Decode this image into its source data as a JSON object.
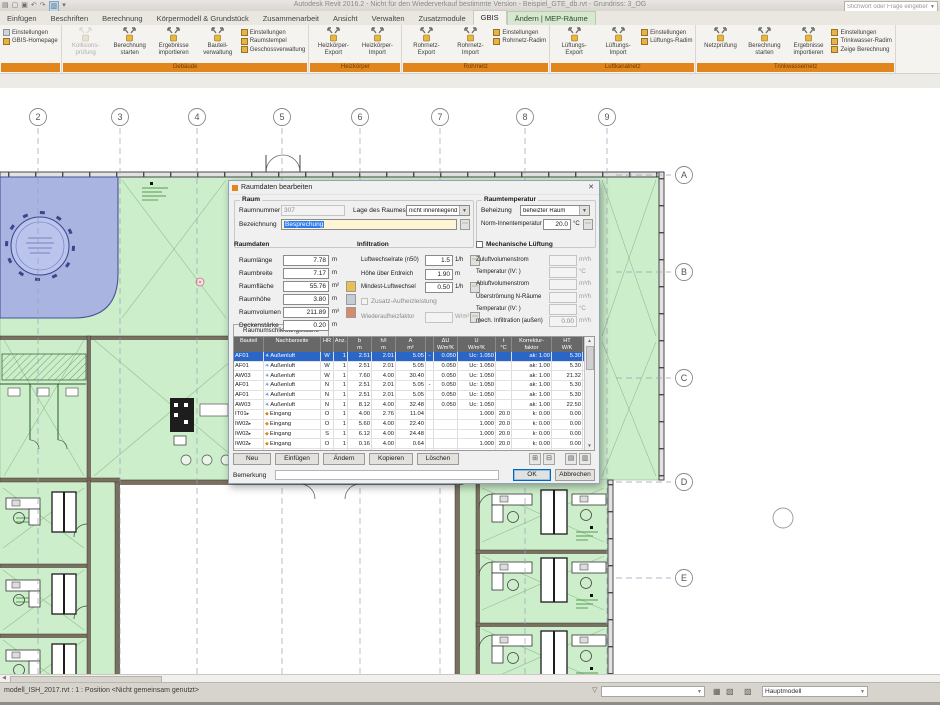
{
  "colors": {
    "ribbon_group_orange": "#e1861c",
    "room_green": "#cdeecb",
    "room_blue": "#a9b4e0",
    "selection_blue": "#2a65c8",
    "contextual_tab_green": "#d8e8d0"
  },
  "titlebar": {
    "title": "Autodesk Revit 2016.2 - Nicht für den Wiederverkauf bestimmte Version - Beispiel_GTE_db.rvt - Grundriss: 3_OG",
    "search_placeholder": "Stichwort oder Frage eingeben",
    "qat_icons": [
      "menu-icon",
      "open-icon",
      "save-icon",
      "undo-icon",
      "redo-icon",
      "print-icon",
      "highlight-icon"
    ]
  },
  "tabs": [
    {
      "label": "Einfügen",
      "active": false,
      "contextual": false
    },
    {
      "label": "Beschriften",
      "active": false,
      "contextual": false
    },
    {
      "label": "Berechnung",
      "active": false,
      "contextual": false
    },
    {
      "label": "Körpermodell & Grundstück",
      "active": false,
      "contextual": false
    },
    {
      "label": "Zusammenarbeit",
      "active": false,
      "contextual": false
    },
    {
      "label": "Ansicht",
      "active": false,
      "contextual": false
    },
    {
      "label": "Verwalten",
      "active": false,
      "contextual": false
    },
    {
      "label": "Zusatzmodule",
      "active": false,
      "contextual": false
    },
    {
      "label": "GBIS",
      "active": true,
      "contextual": false
    },
    {
      "label": "Ändern | MEP-Räume",
      "active": false,
      "contextual": true
    }
  ],
  "ribbon": {
    "partial_group": [
      {
        "label": "Einstellungen"
      },
      {
        "label": "GBIS-Homepage"
      }
    ],
    "groups": [
      {
        "label": "Gebäude",
        "big": [
          {
            "l1": "Kollisions-",
            "l2": "prüfung",
            "disabled": true
          },
          {
            "l1": "Berechnung",
            "l2": "starten",
            "disabled": false
          },
          {
            "l1": "Ergebnisse",
            "l2": "importieren",
            "disabled": false
          },
          {
            "l1": "Bauteil-",
            "l2": "verwaltung",
            "disabled": false
          }
        ],
        "stack": [
          "Einstellungen",
          "Raumstempel",
          "Geschossverwaltung"
        ]
      },
      {
        "label": "Heizkörper",
        "big": [
          {
            "l1": "Heizkörper-",
            "l2": "Export",
            "disabled": false
          },
          {
            "l1": "Heizkörper-",
            "l2": "Import",
            "disabled": false
          }
        ],
        "stack": []
      },
      {
        "label": "Rohrnetz",
        "big": [
          {
            "l1": "Rohrnetz-",
            "l2": "Export",
            "disabled": false
          },
          {
            "l1": "Rohrnetz-",
            "l2": "Import",
            "disabled": false
          }
        ],
        "stack": [
          "Einstellungen",
          "Rohrnetz-Radim"
        ]
      },
      {
        "label": "Luftkanalnetz",
        "big": [
          {
            "l1": "Lüftungs-",
            "l2": "Export",
            "disabled": false
          },
          {
            "l1": "Lüftungs-",
            "l2": "Import",
            "disabled": false
          }
        ],
        "stack": [
          "Einstellungen",
          "Lüftungs-Radim"
        ]
      },
      {
        "label": "Trinkwassernetz",
        "big": [
          {
            "l1": "Netzprüfung",
            "l2": "",
            "disabled": false
          },
          {
            "l1": "Berechnung",
            "l2": "starten",
            "disabled": false
          },
          {
            "l1": "Ergebnisse",
            "l2": "importieren",
            "disabled": false
          }
        ],
        "stack": [
          "Einstellungen",
          "Trinkwasser-Radim",
          "Zeige Berechnung"
        ]
      }
    ]
  },
  "plan": {
    "grid_numbers": [
      "2",
      "3",
      "4",
      "5",
      "6",
      "7",
      "8",
      "9"
    ],
    "grid_letters": [
      "A",
      "B",
      "C",
      "D",
      "E"
    ]
  },
  "dialog": {
    "title": "Raumdaten bearbeiten",
    "raum": {
      "label": "Raum",
      "raumnummer_label": "Raumnummer",
      "raumnummer_value": "307",
      "lage_label": "Lage des Raumes",
      "lage_value": "nicht innenliegend",
      "bezeichnung_label": "Bezeichnung",
      "bezeichnung_value": "Besprechung"
    },
    "raumtemperatur": {
      "label": "Raumtemperatur",
      "beheizung_label": "Beheizung",
      "beheizung_value": "beheizter Raum",
      "norm_label": "Norm-Innentemperatur",
      "norm_value": "20.0",
      "norm_unit": "°C"
    },
    "raumdaten": {
      "label": "Raumdaten",
      "rows": [
        {
          "label": "Raumlänge",
          "value": "7.78",
          "unit": "m",
          "icon": ""
        },
        {
          "label": "Raumbreite",
          "value": "7.17",
          "unit": "m",
          "icon": ""
        },
        {
          "label": "Raumfläche",
          "value": "55.76",
          "unit": "m²",
          "icon": "area-pick-icon"
        },
        {
          "label": "Raumhöhe",
          "value": "3.80",
          "unit": "m",
          "icon": "height-pick-icon"
        },
        {
          "label": "Raumvolumen",
          "value": "211.89",
          "unit": "m³",
          "icon": "volume-pick-icon"
        },
        {
          "label": "Deckenstärke",
          "value": "0.20",
          "unit": "m",
          "icon": ""
        }
      ]
    },
    "infiltration": {
      "label": "Infiltration",
      "rows": [
        {
          "label": "Luftwechselrate (n50)",
          "value": "1.5",
          "unit": "1/h",
          "btn": true
        },
        {
          "label": "Höhe über Erdreich",
          "value": "1.90",
          "unit": "m",
          "btn": false
        },
        {
          "label": "Mindest-Luftwechsel",
          "value": "0.50",
          "unit": "1/h",
          "btn": true
        }
      ],
      "checkbox_label": "Zusatz-Aufheizleistung",
      "wieder_label": "Wiederaufheizfaktor",
      "wieder_unit": "W/m²"
    },
    "lueftung": {
      "label": "Mechanische Lüftung",
      "rows": [
        {
          "label": "Zuluftvolumenstrom",
          "value": "",
          "unit": "m³/h"
        },
        {
          "label": "Temperatur (IV:        )",
          "value": "",
          "unit": "°C"
        },
        {
          "label": "Abluftvolumenstrom",
          "value": "",
          "unit": "m³/h"
        },
        {
          "label": "Überströmung N-Räume",
          "value": "",
          "unit": "m³/h"
        },
        {
          "label": "Temperatur (IV:        )",
          "value": "",
          "unit": "°C"
        },
        {
          "label": "mech. Infiltration (außen)",
          "value": "0.00",
          "unit": "m³/h"
        }
      ]
    },
    "tab_label": "Raumumschließungsfläche",
    "table": {
      "headers": [
        [
          "Bauteil",
          ""
        ],
        [
          "Nachbarseite",
          ""
        ],
        [
          "HR",
          ""
        ],
        [
          "Anz.",
          ""
        ],
        [
          "b",
          "m"
        ],
        [
          "h/l",
          "m"
        ],
        [
          "A",
          "m²"
        ],
        [
          "",
          ""
        ],
        [
          "ΔU",
          "W/m²K"
        ],
        [
          "U",
          "W/m²K"
        ],
        [
          "t",
          "°C"
        ],
        [
          "Korrektur-",
          "faktor"
        ],
        [
          "HT",
          "W/K"
        ]
      ],
      "rows": [
        {
          "bauteil": "AF01",
          "flag": false,
          "typ": "Außenluft",
          "hr": "W",
          "anz": "1",
          "b": "2.51",
          "hl": "2.01",
          "a": "5.05",
          "dash": "-",
          "du": "0.050",
          "u": "Uc:  1.050",
          "t": "",
          "korr": "ak:  1.00",
          "ht": "5.30",
          "selected": true
        },
        {
          "bauteil": "AF01",
          "flag": false,
          "typ": "Außenluft",
          "hr": "W",
          "anz": "1",
          "b": "2.51",
          "hl": "2.01",
          "a": "5.05",
          "dash": "",
          "du": "0.050",
          "u": "Uc:  1.050",
          "t": "",
          "korr": "ak:  1.00",
          "ht": "5.30",
          "selected": false
        },
        {
          "bauteil": "AW03",
          "flag": false,
          "typ": "Außenluft",
          "hr": "W",
          "anz": "1",
          "b": "7.60",
          "hl": "4.00",
          "a": "30.40",
          "dash": "",
          "du": "0.050",
          "u": "Uc:  1.050",
          "t": "",
          "korr": "ak:  1.00",
          "ht": "21.32",
          "selected": false
        },
        {
          "bauteil": "AF01",
          "flag": false,
          "typ": "Außenluft",
          "hr": "N",
          "anz": "1",
          "b": "2.51",
          "hl": "2.01",
          "a": "5.05",
          "dash": "-",
          "du": "0.050",
          "u": "Uc:  1.050",
          "t": "",
          "korr": "ak:  1.00",
          "ht": "5.30",
          "selected": false
        },
        {
          "bauteil": "AF01",
          "flag": false,
          "typ": "Außenluft",
          "hr": "N",
          "anz": "1",
          "b": "2.51",
          "hl": "2.01",
          "a": "5.05",
          "dash": "",
          "du": "0.050",
          "u": "Uc:  1.050",
          "t": "",
          "korr": "ak:  1.00",
          "ht": "5.30",
          "selected": false
        },
        {
          "bauteil": "AW03",
          "flag": false,
          "typ": "Außenluft",
          "hr": "N",
          "anz": "1",
          "b": "8.12",
          "hl": "4.00",
          "a": "32.48",
          "dash": "",
          "du": "0.050",
          "u": "Uc:  1.050",
          "t": "",
          "korr": "ak:  1.00",
          "ht": "22.50",
          "selected": false
        },
        {
          "bauteil": "IT01",
          "flag": true,
          "typ": "Eingang",
          "hr": "O",
          "anz": "1",
          "b": "4.00",
          "hl": "2.76",
          "a": "11.04",
          "dash": "",
          "du": "",
          "u": "1.000",
          "t": "20.0",
          "korr": "k:  0.00",
          "ht": "0.00",
          "selected": false
        },
        {
          "bauteil": "IW02",
          "flag": true,
          "typ": "Eingang",
          "hr": "O",
          "anz": "1",
          "b": "5.60",
          "hl": "4.00",
          "a": "22.40",
          "dash": "",
          "du": "",
          "u": "1.000",
          "t": "20.0",
          "korr": "k:  0.00",
          "ht": "0.00",
          "selected": false
        },
        {
          "bauteil": "IW02",
          "flag": true,
          "typ": "Eingang",
          "hr": "S",
          "anz": "1",
          "b": "6.12",
          "hl": "4.00",
          "a": "24.48",
          "dash": "",
          "du": "",
          "u": "1.000",
          "t": "20.0",
          "korr": "k:  0.00",
          "ht": "0.00",
          "selected": false
        },
        {
          "bauteil": "IW02",
          "flag": true,
          "typ": "Eingang",
          "hr": "O",
          "anz": "1",
          "b": "0.16",
          "hl": "4.00",
          "a": "0.64",
          "dash": "",
          "du": "",
          "u": "1.000",
          "t": "20.0",
          "korr": "k:  0.00",
          "ht": "0.00",
          "selected": false
        },
        {
          "bauteil": "IW02",
          "flag": true,
          "typ": "Eingang",
          "hr": "O",
          "anz": "1",
          "b": "0.16",
          "hl": "4.00",
          "a": "0.64",
          "dash": "",
          "du": "",
          "u": "1.000",
          "t": "20.0",
          "korr": "k:  0.00",
          "ht": "0.00",
          "selected": false
        }
      ]
    },
    "buttons": [
      "Neu",
      "Einfügen",
      "Ändern",
      "Kopieren",
      "Löschen"
    ],
    "bemerkung_label": "Bemerkung",
    "ok_label": "OK",
    "cancel_label": "Abbrechen"
  },
  "statusbar": {
    "left_text": "modell_ISH_2017.rvt : 1 : Position <Nicht gemeinsam genutzt>",
    "dropdown_value": "Hauptmodell"
  }
}
